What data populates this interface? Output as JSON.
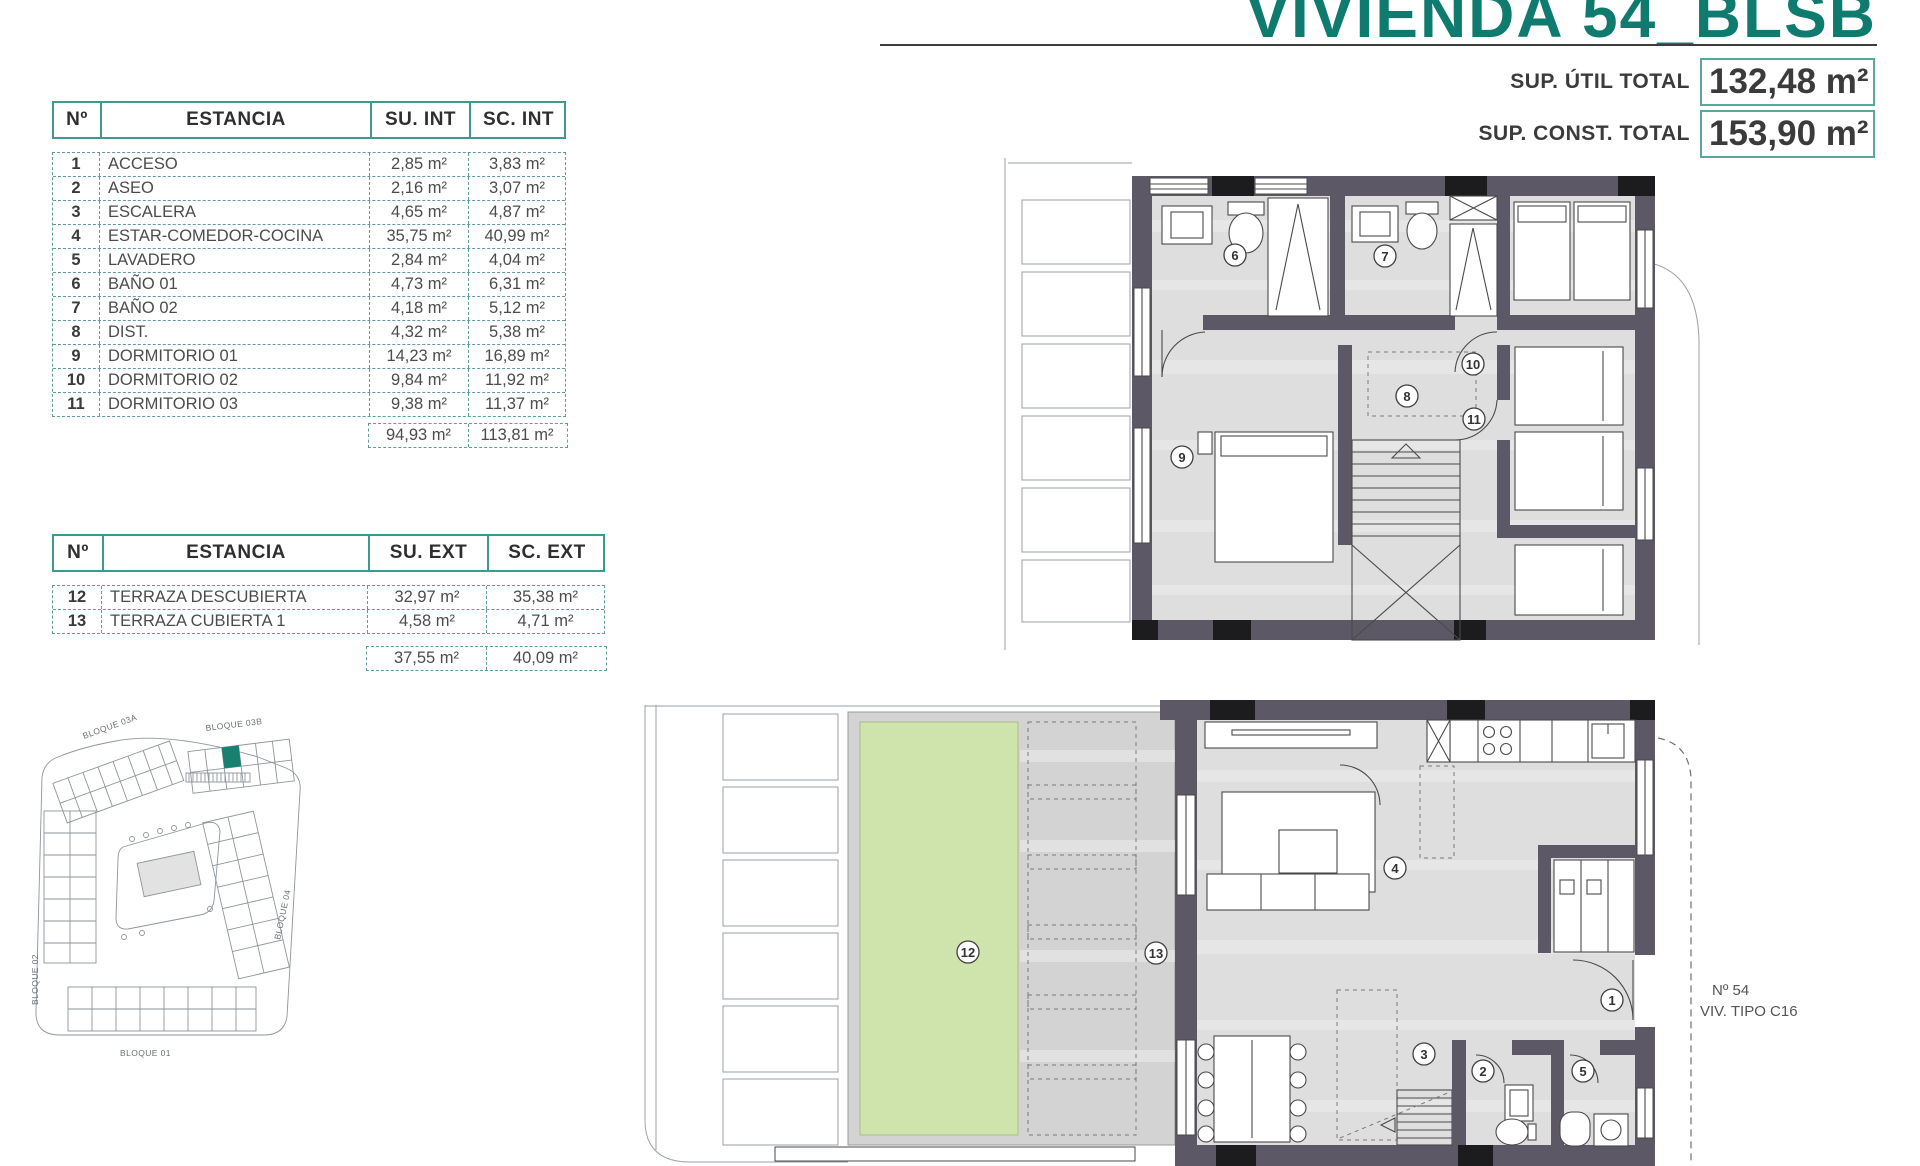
{
  "title": "VIVIENDA 54_BLSB",
  "summary": {
    "util_label": "SUP. ÚTIL TOTAL",
    "util_value": "132,48 m²",
    "const_label": "SUP. CONST. TOTAL",
    "const_value": "153,90 m²"
  },
  "interior_table": {
    "headers": {
      "n": "Nº",
      "room": "ESTANCIA",
      "su": "SU. INT",
      "sc": "SC. INT"
    },
    "rows": [
      {
        "n": "1",
        "room": "ACCESO",
        "su": "2,85 m²",
        "sc": "3,83 m²"
      },
      {
        "n": "2",
        "room": "ASEO",
        "su": "2,16 m²",
        "sc": "3,07 m²"
      },
      {
        "n": "3",
        "room": "ESCALERA",
        "su": "4,65 m²",
        "sc": "4,87 m²"
      },
      {
        "n": "4",
        "room": "ESTAR-COMEDOR-COCINA",
        "su": "35,75 m²",
        "sc": "40,99 m²"
      },
      {
        "n": "5",
        "room": "LAVADERO",
        "su": "2,84 m²",
        "sc": "4,04 m²"
      },
      {
        "n": "6",
        "room": "BAÑO 01",
        "su": "4,73 m²",
        "sc": "6,31 m²"
      },
      {
        "n": "7",
        "room": "BAÑO 02",
        "su": "4,18 m²",
        "sc": "5,12 m²"
      },
      {
        "n": "8",
        "room": "DIST.",
        "su": "4,32 m²",
        "sc": "5,38 m²"
      },
      {
        "n": "9",
        "room": "DORMITORIO 01",
        "su": "14,23 m²",
        "sc": "16,89 m²"
      },
      {
        "n": "10",
        "room": "DORMITORIO 02",
        "su": "9,84 m²",
        "sc": "11,92 m²"
      },
      {
        "n": "11",
        "room": "DORMITORIO 03",
        "su": "9,38 m²",
        "sc": "11,37 m²"
      }
    ],
    "totals": {
      "su": "94,93 m²",
      "sc": "113,81 m²"
    }
  },
  "exterior_table": {
    "headers": {
      "n": "Nº",
      "room": "ESTANCIA",
      "su": "SU. EXT",
      "sc": "SC. EXT"
    },
    "rows": [
      {
        "n": "12",
        "room": "TERRAZA DESCUBIERTA",
        "su": "32,97 m²",
        "sc": "35,38 m²"
      },
      {
        "n": "13",
        "room": "TERRAZA CUBIERTA 1",
        "su": "4,58 m²",
        "sc": "4,71 m²"
      }
    ],
    "totals": {
      "su": "37,55 m²",
      "sc": "40,09 m²"
    }
  },
  "site_plan": {
    "blocks": {
      "b03a": "BLOQUE 03A",
      "b03b": "BLOQUE 03B",
      "b02": "BLOQUE 02",
      "b04": "BLOQUE 04",
      "b01": "BLOQUE 01"
    }
  },
  "plans": {
    "upper_rooms": [
      "6",
      "7",
      "8",
      "9",
      "10",
      "11"
    ],
    "ground_rooms": [
      "1",
      "2",
      "3",
      "4",
      "5",
      "12",
      "13"
    ],
    "unit_label_line1": "Nº 54",
    "unit_label_line2": "VIV. TIPO C16"
  },
  "colors": {
    "teal": "#0e7b6e",
    "table_border": "#3f9a8e",
    "wall": "#5c5866",
    "floor": "#dedede",
    "deck": "#d3d3d3",
    "grass": "#cfe3ad",
    "highlight_unit": "#17806f"
  }
}
